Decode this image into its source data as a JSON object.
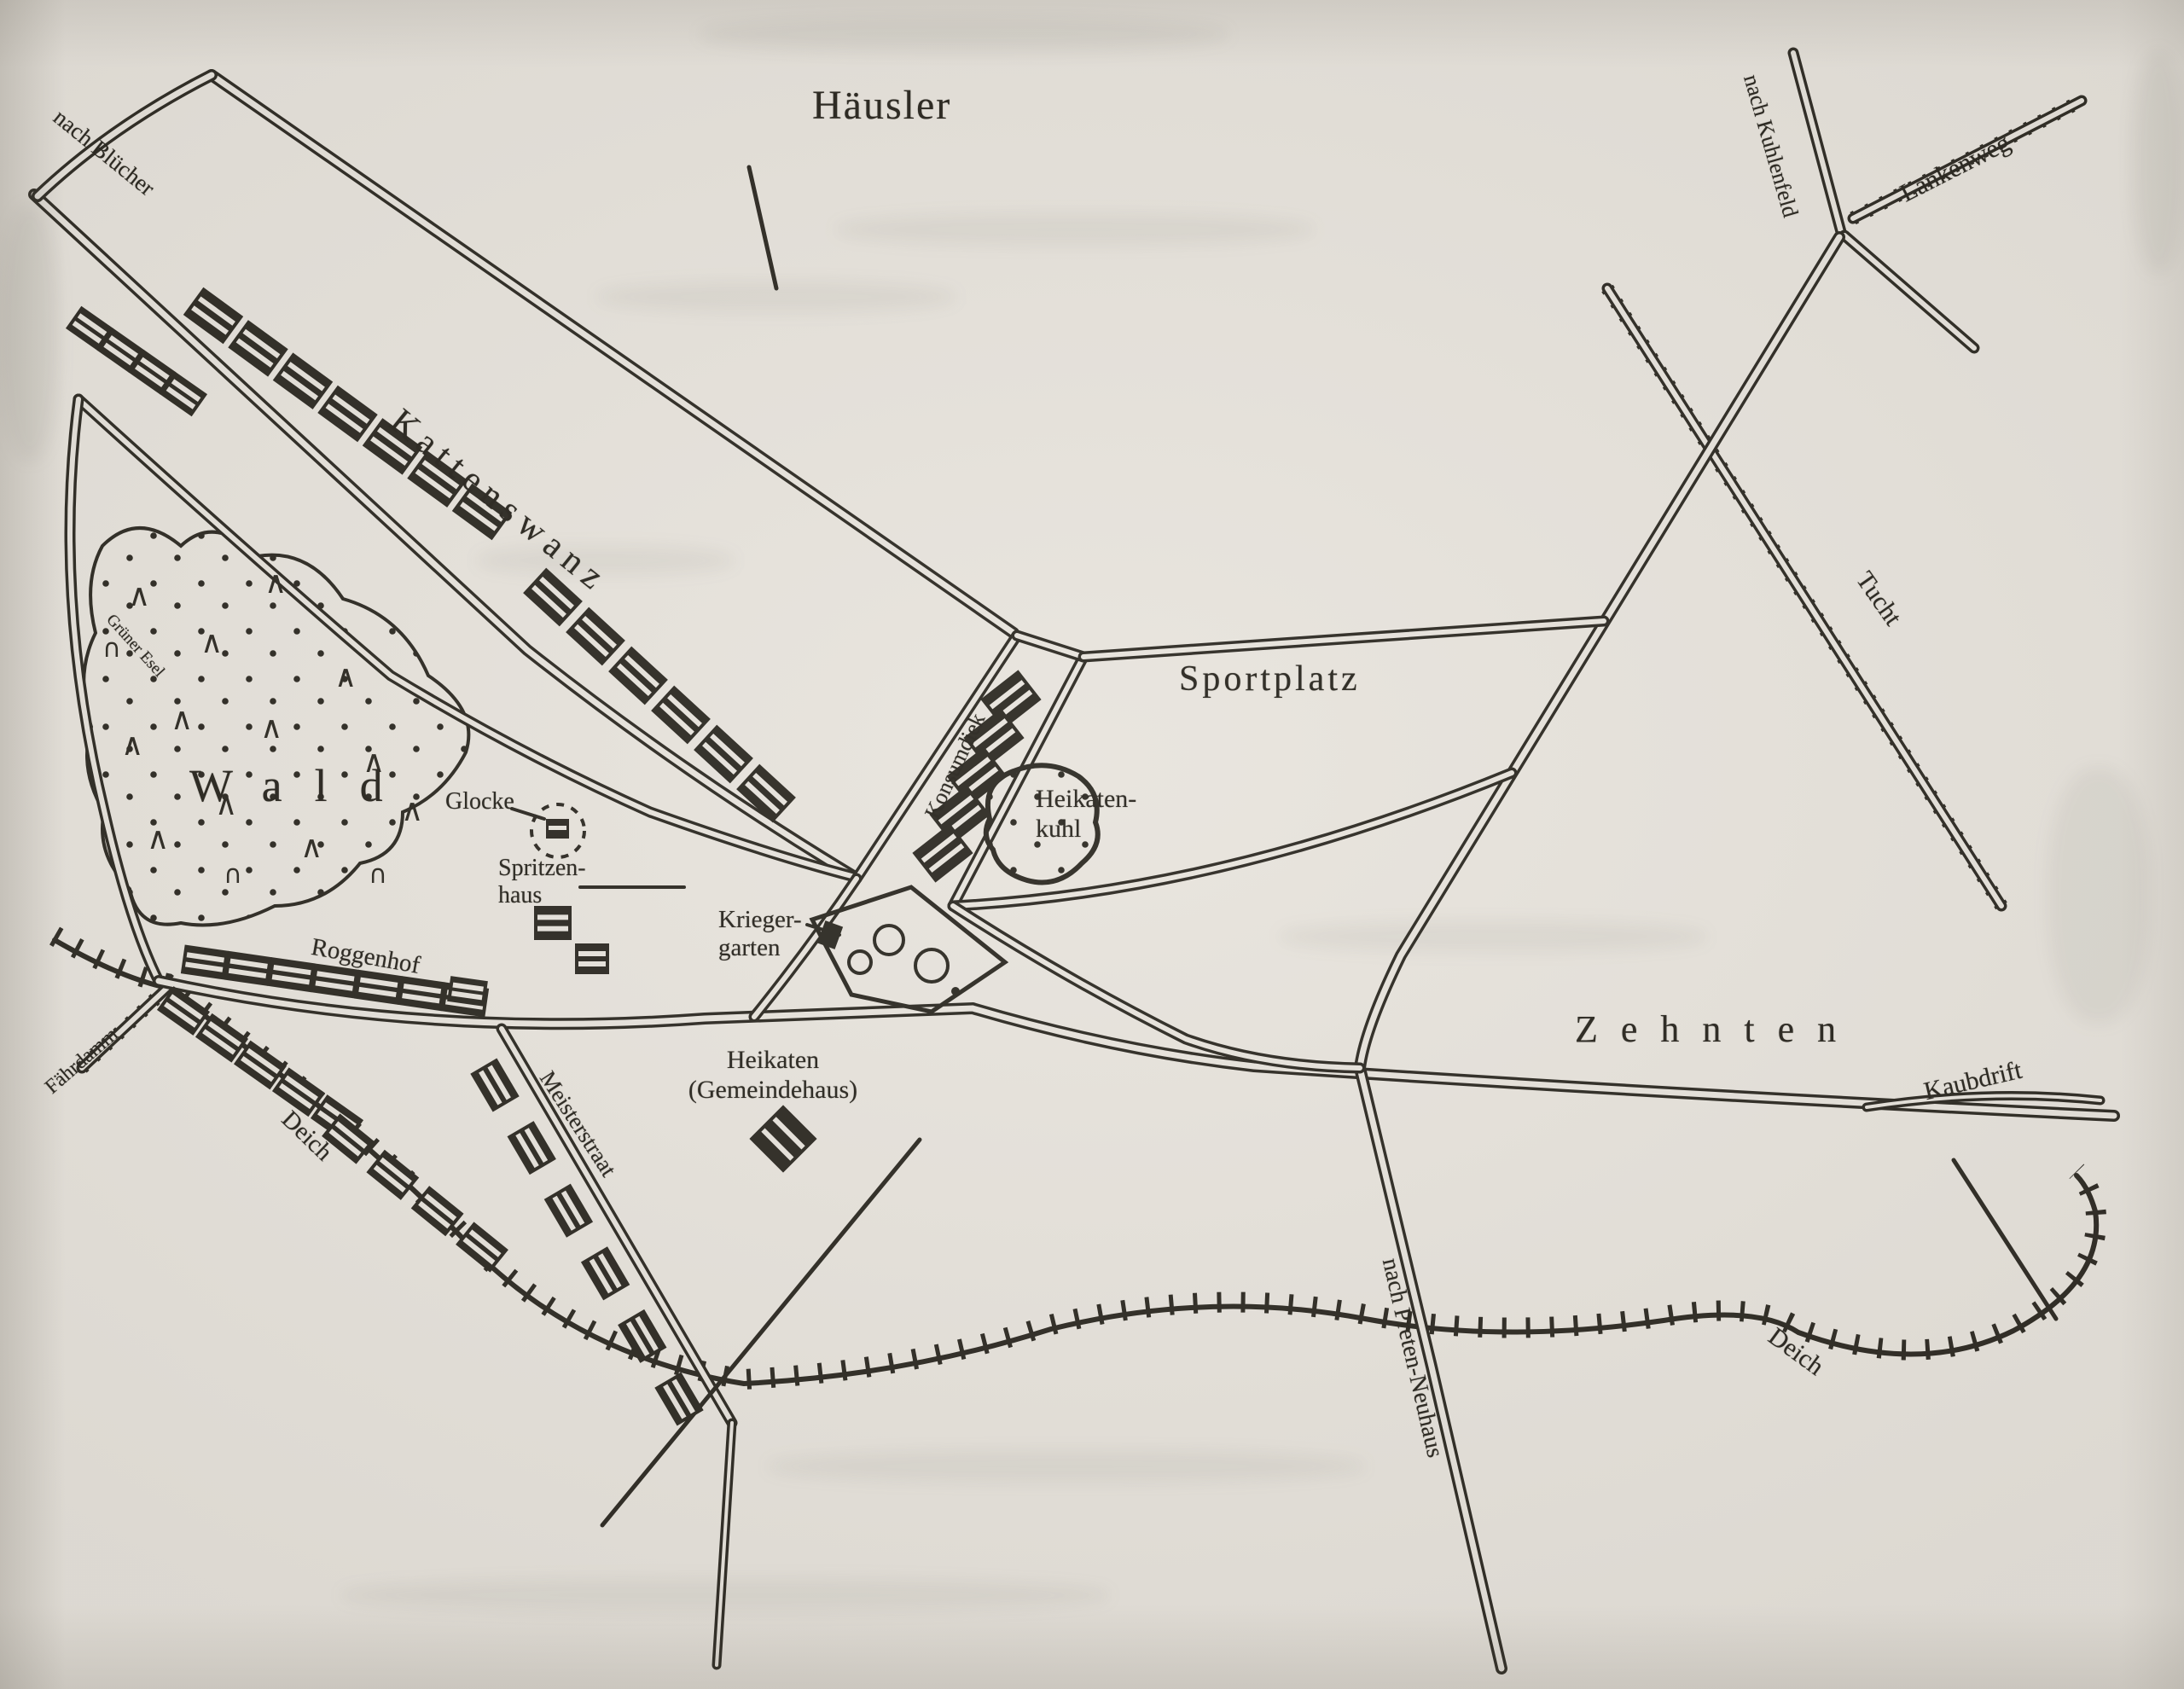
{
  "map": {
    "title": "Häusler",
    "paper_color": "#e8e4dd",
    "ink_color": "#2e2b24",
    "labels": {
      "nach_bluecher": "nach Blücher",
      "kattenswanz": "Kattenswanz",
      "nach_kuhlenfeld": "nach Kuhlenfeld",
      "lankenweg": "Lankenweg",
      "tucht": "Tucht",
      "sportplatz": "Sportplatz",
      "konsumdiek": "Konsumdiek",
      "heikatenkuhl": "Heikaten-\n   kuhl",
      "glocke": "Glocke",
      "spritzenhaus": "Spritzen-\nhaus",
      "wald": "Wald",
      "gruener_esel": "Grüner Esel",
      "roggenhof": "Roggenhof",
      "kriegergarten": "Krieger-\ngarten",
      "faehrdamm": "Fährdamm",
      "deich_west": "Deich",
      "meisterstraat": "Meisterstraat",
      "heikaten_gemeindehaus": "Heikaten\n(Gemeindehaus)",
      "zehnten": "Zehnten",
      "kaubdrift": "Kaubdrift",
      "deich_ost": "Deich",
      "nach_preten_neuhaus": "nach Preten-Neuhaus"
    }
  }
}
